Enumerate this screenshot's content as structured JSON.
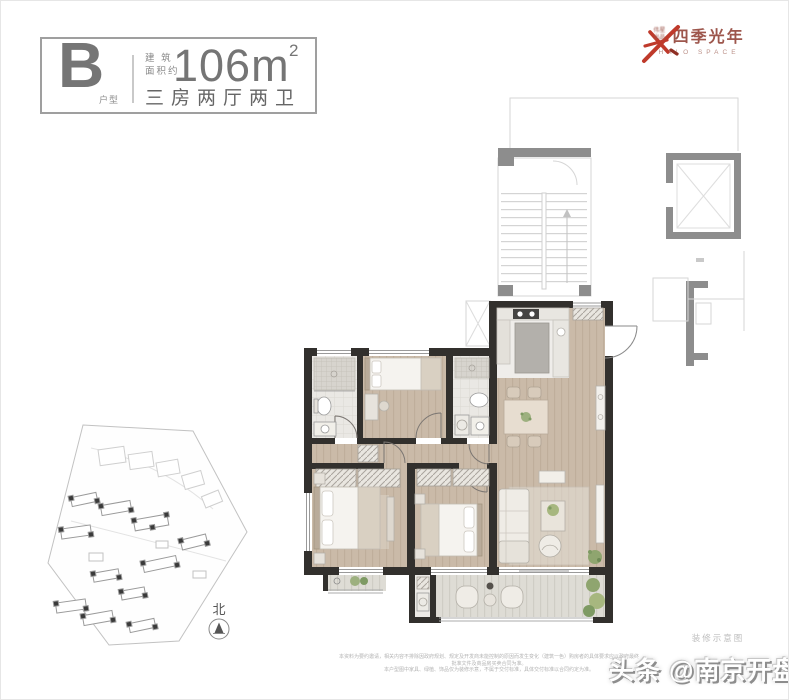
{
  "header": {
    "unit_letter": "B",
    "unit_letter_caption": "户型",
    "area_label_line1": "建 筑",
    "area_label_line2": "面积约",
    "area_value": "106m",
    "area_superscript": "2",
    "layout_description": "三房两厅两卫"
  },
  "brand": {
    "prefix_line1": "伟星",
    "prefix_line2": "出品",
    "separator": "·",
    "name": "四季光年",
    "subtitle": "HALO SPACE"
  },
  "floor_plan": {
    "caption": "装修示意图",
    "rooms": [
      "主卧",
      "次卧",
      "书房",
      "客厅",
      "餐厅",
      "厨房",
      "卫生间",
      "卫生间",
      "阳台",
      "主卧阳台"
    ]
  },
  "compass": {
    "label": "北"
  },
  "disclaimer": {
    "line1": "本资料为要约邀请，相关内容不排除因政府规划、规定及开发商未能控制的原因而发生变化（建筑一色）购房者的具体要求应以政府最终批准文件及商品房买卖合同为准。",
    "line2": "本户型图中家具、绿植、饰品仅为装修示意，不属于交付标准，具体交付标准以合同约定为准。"
  },
  "watermark": {
    "text": "头条 @南京开盘"
  },
  "colors": {
    "brand-red": "#bf3a2b",
    "brand-text": "#9d564c",
    "brand-sub": "#bb9189",
    "wall": "#32302d",
    "header-gray": "#757575"
  }
}
